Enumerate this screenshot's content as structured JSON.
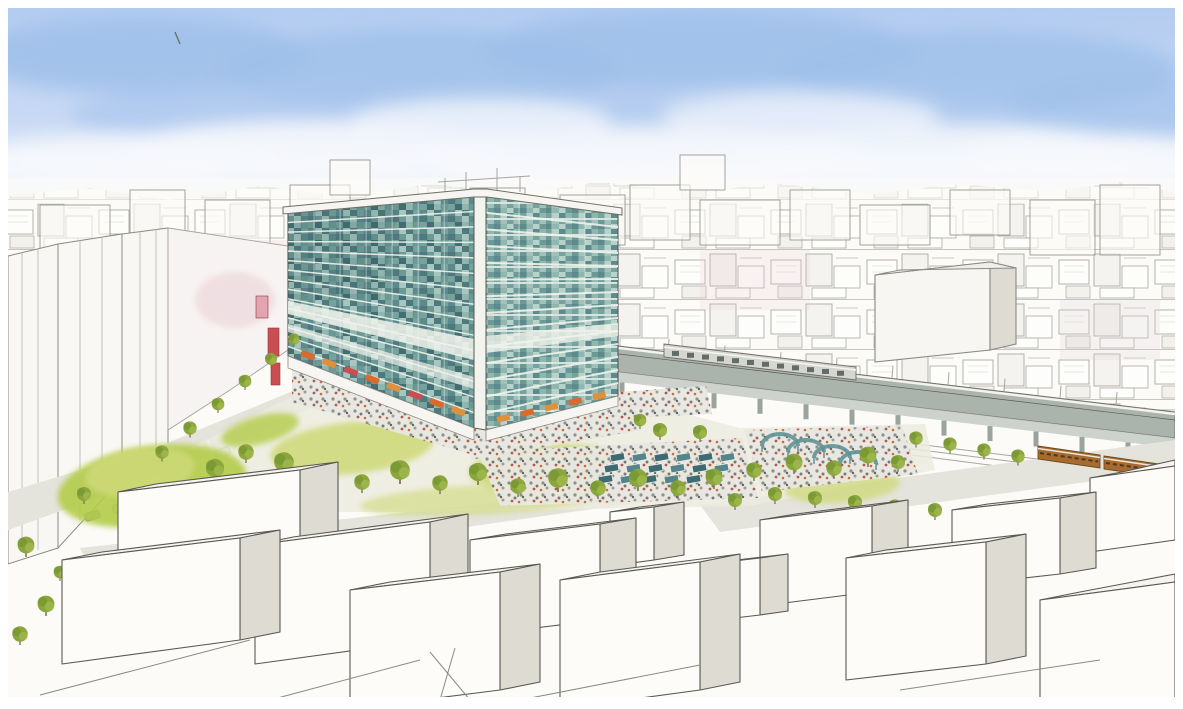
{
  "image": {
    "kind": "watercolor-pen-architectural-rendering",
    "subject": "aerial-view-mixed-use-glass-tower-station-plaza-park-elevated-railway-city"
  },
  "palette": {
    "paper": "#fcfbf8",
    "skyTop": "#b4ccf0",
    "skyMid": "#c8d9f4",
    "skyLow": "#e8eefa",
    "cloudBlue": "#9fc0ea",
    "cloudWhite": "#f4f7fc",
    "ink": "#5a5852",
    "inkLight": "#a8a6a0",
    "wallShade": "#dedbd3",
    "glassDark": "#436d72",
    "glassMid": "#5f9397",
    "glassTeal": "#79aaa4",
    "glassPale": "#a7c6bf",
    "floorBand": "#eff3ec",
    "lawn": "#cdd977",
    "lawnBright": "#b3cc4a",
    "tree": "#8aa63c",
    "treeDark": "#70902e",
    "streetGray": "#e4e3dc",
    "viaduct": "#aab3ac",
    "crowdBase": "#e8e7e1",
    "crowdGray": "#8b8a85",
    "accentOrange": "#d96a2e",
    "accentRed": "#c94e52",
    "accentPink": "#e2a4ae",
    "trainBrown": "#a96a2e"
  },
  "scene": {
    "tower": {
      "leftFacade": [
        288,
        213,
        474,
        196,
        474,
        428,
        288,
        356
      ],
      "rightFacade": [
        486,
        196,
        618,
        214,
        618,
        396,
        486,
        430
      ],
      "floorsLeft": 15,
      "floorsRight": 14,
      "mullionsLeft": [
        0.14,
        0.28,
        0.42,
        0.56,
        0.7,
        0.84
      ],
      "mullionsRight": [
        0.25,
        0.5,
        0.75
      ]
    },
    "awningStrips": [
      {
        "seg": [
          296,
          354,
          468,
          418
        ],
        "n": 8,
        "w": 14,
        "h": 6,
        "colors": [
          "#d96a2e",
          "#e0903a",
          "#c94e52"
        ]
      },
      {
        "seg": [
          492,
          424,
          612,
          396
        ],
        "n": 5,
        "w": 13,
        "h": 6,
        "colors": [
          "#e0903a",
          "#d96a2e"
        ]
      }
    ],
    "banners": [
      [
        268,
        328,
        11,
        28,
        "#c94e52"
      ],
      [
        271,
        363,
        9,
        22,
        "#c94e52"
      ],
      [
        256,
        296,
        12,
        22,
        "#e2a4ae"
      ]
    ],
    "skylineBoxes": [
      [
        40,
        205,
        70,
        55
      ],
      [
        130,
        190,
        55,
        70
      ],
      [
        205,
        200,
        65,
        55
      ],
      [
        290,
        185,
        60,
        40
      ],
      [
        330,
        160,
        40,
        35
      ],
      [
        395,
        198,
        75,
        50
      ],
      [
        470,
        188,
        55,
        45
      ],
      [
        560,
        195,
        65,
        50
      ],
      [
        630,
        185,
        60,
        55
      ],
      [
        680,
        155,
        45,
        35
      ],
      [
        700,
        200,
        80,
        45
      ],
      [
        790,
        190,
        60,
        50
      ],
      [
        860,
        205,
        70,
        40
      ],
      [
        950,
        190,
        60,
        45
      ],
      [
        1030,
        200,
        65,
        55
      ],
      [
        1100,
        185,
        60,
        70
      ]
    ],
    "lawns": [
      [
        152,
        486,
        95,
        40,
        -8,
        "#b3cc4a",
        0.9
      ],
      [
        140,
        472,
        55,
        24,
        -8,
        "#cdd977",
        0.9
      ],
      [
        260,
        430,
        40,
        14,
        -15,
        "#b3cc4a",
        0.8
      ],
      [
        352,
        448,
        82,
        26,
        -6,
        "#cdd977",
        0.85
      ],
      [
        545,
        468,
        76,
        24,
        -4,
        "#cdd977",
        0.85
      ],
      [
        688,
        470,
        50,
        17,
        -4,
        "#cdd977",
        0.8
      ],
      [
        842,
        486,
        58,
        17,
        -4,
        "#cdd977",
        0.75
      ],
      [
        480,
        500,
        120,
        15,
        -3,
        "#cdd977",
        0.6
      ]
    ],
    "crowds": [
      [
        292,
        362,
        470,
        420,
        470,
        454,
        292,
        402
      ],
      [
        470,
        424,
        616,
        397,
        642,
        430,
        470,
        460
      ],
      [
        478,
        452,
        742,
        438,
        758,
        498,
        500,
        506
      ],
      [
        744,
        430,
        902,
        426,
        918,
        474,
        762,
        492
      ],
      [
        618,
        392,
        706,
        386,
        712,
        414,
        622,
        418
      ]
    ],
    "stalls": {
      "w": 14,
      "h": 7,
      "angle": -10,
      "items": [
        [
          610,
          455
        ],
        [
          632,
          455
        ],
        [
          654,
          455
        ],
        [
          676,
          455
        ],
        [
          698,
          455
        ],
        [
          720,
          455
        ],
        [
          604,
          466
        ],
        [
          626,
          466
        ],
        [
          648,
          466
        ],
        [
          670,
          466
        ],
        [
          692,
          466
        ],
        [
          714,
          466
        ],
        [
          598,
          477
        ],
        [
          620,
          477
        ],
        [
          642,
          477
        ],
        [
          664,
          477
        ],
        [
          686,
          477
        ],
        [
          708,
          477
        ]
      ]
    },
    "arcs": [
      [
        780,
        446
      ],
      [
        806,
        452
      ],
      [
        832,
        458
      ],
      [
        858,
        464
      ]
    ],
    "trees": [
      [
        215,
        468,
        1.3
      ],
      [
        246,
        452,
        1.1
      ],
      [
        284,
        462,
        1.4
      ],
      [
        320,
        478,
        1.2
      ],
      [
        362,
        482,
        1.1
      ],
      [
        400,
        470,
        1.4
      ],
      [
        440,
        483,
        1.1
      ],
      [
        478,
        472,
        1.3
      ],
      [
        518,
        486,
        1.1
      ],
      [
        558,
        478,
        1.4
      ],
      [
        598,
        488,
        1.1
      ],
      [
        638,
        478,
        1.3
      ],
      [
        678,
        488,
        1.1
      ],
      [
        714,
        477,
        1.2
      ],
      [
        754,
        470,
        1.1
      ],
      [
        794,
        462,
        1.2
      ],
      [
        834,
        468,
        1.1
      ],
      [
        868,
        455,
        1.2
      ],
      [
        898,
        462,
        1.0
      ],
      [
        916,
        438,
        0.95
      ],
      [
        950,
        444,
        0.95
      ],
      [
        984,
        450,
        0.95
      ],
      [
        1018,
        456,
        0.95
      ],
      [
        735,
        500,
        1.0
      ],
      [
        775,
        494,
        1.0
      ],
      [
        815,
        498,
        1.0
      ],
      [
        855,
        502,
        1.0
      ],
      [
        895,
        506,
        0.95
      ],
      [
        935,
        510,
        1.0
      ],
      [
        975,
        514,
        0.95
      ],
      [
        1015,
        518,
        1.0
      ],
      [
        1055,
        524,
        0.95
      ],
      [
        1095,
        530,
        1.0
      ],
      [
        1135,
        536,
        0.95
      ],
      [
        162,
        452,
        0.95
      ],
      [
        190,
        428,
        0.95
      ],
      [
        218,
        404,
        0.9
      ],
      [
        245,
        381,
        0.9
      ],
      [
        271,
        359,
        0.85
      ],
      [
        294,
        339,
        0.8
      ],
      [
        26,
        545,
        1.2
      ],
      [
        46,
        604,
        1.2
      ],
      [
        84,
        494,
        1.0
      ],
      [
        20,
        634,
        1.1
      ],
      [
        60,
        572,
        0.9
      ],
      [
        640,
        420,
        0.9
      ],
      [
        660,
        430,
        1.0
      ],
      [
        700,
        432,
        1.0
      ]
    ],
    "fgBoxes": [
      {
        "t": [
          1090,
          478,
          1122,
          472,
          1175,
          460,
          1175,
          466
        ],
        "f": [
          1090,
          478,
          1175,
          466,
          1175,
          540,
          1090,
          552
        ]
      },
      {
        "t": [
          118,
          492,
          156,
          484,
          338,
          462,
          300,
          470
        ],
        "f": [
          118,
          492,
          300,
          470,
          300,
          560,
          118,
          584
        ],
        "s": [
          300,
          470,
          338,
          462,
          338,
          552,
          300,
          560
        ]
      },
      {
        "t": [
          952,
          510,
          988,
          504,
          1096,
          492,
          1060,
          498
        ],
        "f": [
          952,
          510,
          1060,
          498,
          1060,
          574,
          952,
          586
        ],
        "s": [
          1060,
          498,
          1096,
          492,
          1096,
          568,
          1060,
          574
        ]
      },
      {
        "t": [
          610,
          512,
          640,
          507,
          684,
          502,
          654,
          507
        ],
        "f": [
          610,
          512,
          654,
          507,
          654,
          560,
          610,
          566
        ],
        "s": [
          654,
          507,
          684,
          502,
          684,
          555,
          654,
          560
        ]
      },
      {
        "t": [
          760,
          520,
          796,
          514,
          908,
          500,
          872,
          506
        ],
        "f": [
          760,
          520,
          872,
          506,
          872,
          592,
          760,
          606
        ],
        "s": [
          872,
          506,
          908,
          500,
          908,
          586,
          872,
          592
        ]
      },
      {
        "t": [
          470,
          540,
          506,
          534,
          636,
          518,
          600,
          524
        ],
        "f": [
          470,
          540,
          600,
          524,
          600,
          620,
          470,
          636
        ],
        "s": [
          600,
          524,
          636,
          518,
          636,
          614,
          600,
          620
        ]
      },
      {
        "t": [
          255,
          545,
          293,
          537,
          468,
          514,
          430,
          522
        ],
        "f": [
          255,
          545,
          430,
          522,
          430,
          640,
          255,
          664
        ],
        "s": [
          430,
          522,
          468,
          514,
          468,
          632,
          430,
          640
        ]
      },
      {
        "t": [
          62,
          560,
          102,
          552,
          280,
          530,
          240,
          538
        ],
        "f": [
          62,
          560,
          240,
          538,
          240,
          640,
          62,
          664
        ],
        "s": [
          240,
          538,
          280,
          530,
          280,
          632,
          240,
          640
        ]
      },
      {
        "t": [
          846,
          558,
          886,
          550,
          1026,
          534,
          986,
          542
        ],
        "f": [
          846,
          558,
          986,
          542,
          986,
          664,
          846,
          680
        ],
        "s": [
          986,
          542,
          1026,
          534,
          1026,
          656,
          986,
          664
        ]
      },
      {
        "t": [
          700,
          565,
          728,
          561,
          788,
          554,
          760,
          558
        ],
        "f": [
          700,
          565,
          760,
          558,
          760,
          615,
          700,
          622
        ],
        "s": [
          760,
          558,
          788,
          554,
          788,
          611,
          760,
          615
        ]
      },
      {
        "t": [
          560,
          580,
          600,
          572,
          740,
          554,
          700,
          562
        ],
        "f": [
          560,
          580,
          700,
          562,
          700,
          690,
          560,
          709
        ],
        "s": [
          700,
          562,
          740,
          554,
          740,
          682,
          700,
          690
        ]
      },
      {
        "t": [
          350,
          590,
          390,
          582,
          540,
          564,
          500,
          572
        ],
        "f": [
          350,
          590,
          500,
          572,
          500,
          690,
          350,
          709
        ],
        "s": [
          500,
          572,
          540,
          564,
          540,
          682,
          500,
          690
        ]
      },
      {
        "t": [
          1040,
          600,
          1080,
          592,
          1175,
          574,
          1175,
          582
        ],
        "f": [
          1040,
          600,
          1175,
          582,
          1175,
          709,
          1040,
          709
        ]
      }
    ],
    "viaduct": {
      "pierX0": 622,
      "pierX1": 1164,
      "pierStep": 46,
      "baseX": 602,
      "topY": 380,
      "slope": 0.1187
    },
    "grayTrainWindows": {
      "n": 12,
      "x0": 672,
      "step": 15,
      "baseX": 664,
      "baseY": 348,
      "slope": 0.12
    },
    "catenary": {
      "x0": 612,
      "x1": 1160,
      "step": 56,
      "baseX": 602,
      "baseY": 344,
      "slope": 0.1187,
      "h": 13
    },
    "crosswalk": {
      "x": 170,
      "y": 456,
      "n": 6,
      "dx": 7.2,
      "dy": -3.0,
      "w": 3.5,
      "h": 15,
      "angle": -22
    },
    "cars": [
      [
        112,
        506,
        -17,
        "#cdd0cb"
      ],
      [
        84,
        514,
        -17,
        "#8fa7ad"
      ],
      [
        214,
        452,
        -22,
        "#d8d8d2"
      ]
    ]
  }
}
